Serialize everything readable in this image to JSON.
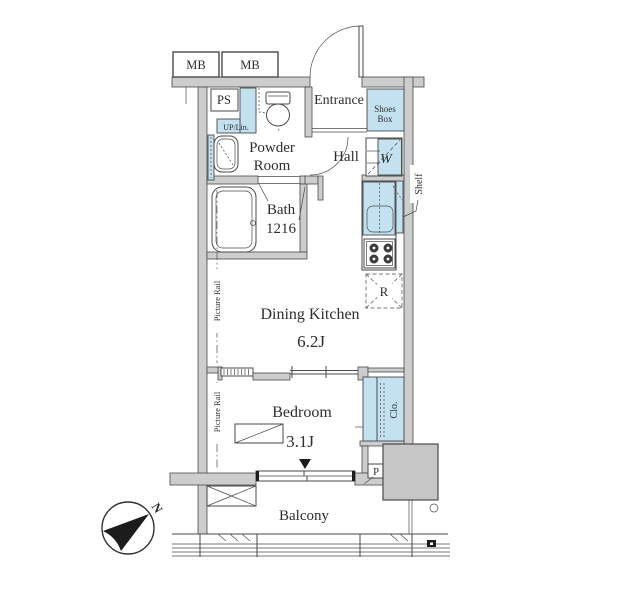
{
  "colors": {
    "wall_fill": "#cdcdcd",
    "line": "#4a4a4a",
    "accent_blue": "#c3e1ef",
    "fixture_gray": "#c6c6c6",
    "text": "#2e2e2e"
  },
  "labels": {
    "mb_left": "MB",
    "mb_right": "MB",
    "ps": "PS",
    "up_lin": "UP/Lin.",
    "powder_line1": "Powder",
    "powder_line2": "Room",
    "entrance": "Entrance",
    "shoes_line1": "Shoes",
    "shoes_line2": "Box",
    "hall": "Hall",
    "washer": "W",
    "shelf": "Shelf",
    "bath_name": "Bath",
    "bath_size": "1216",
    "dining_kitchen": "Dining Kitchen",
    "dining_kitchen_size": "6.2J",
    "refrigerator": "R",
    "picture_rail_dk": "Picture Rail",
    "picture_rail_bedroom": "Picture Rail",
    "closet": "Clo.",
    "bedroom": "Bedroom",
    "bedroom_size": "3.1J",
    "pole": "P",
    "balcony": "Balcony",
    "north": "N"
  }
}
